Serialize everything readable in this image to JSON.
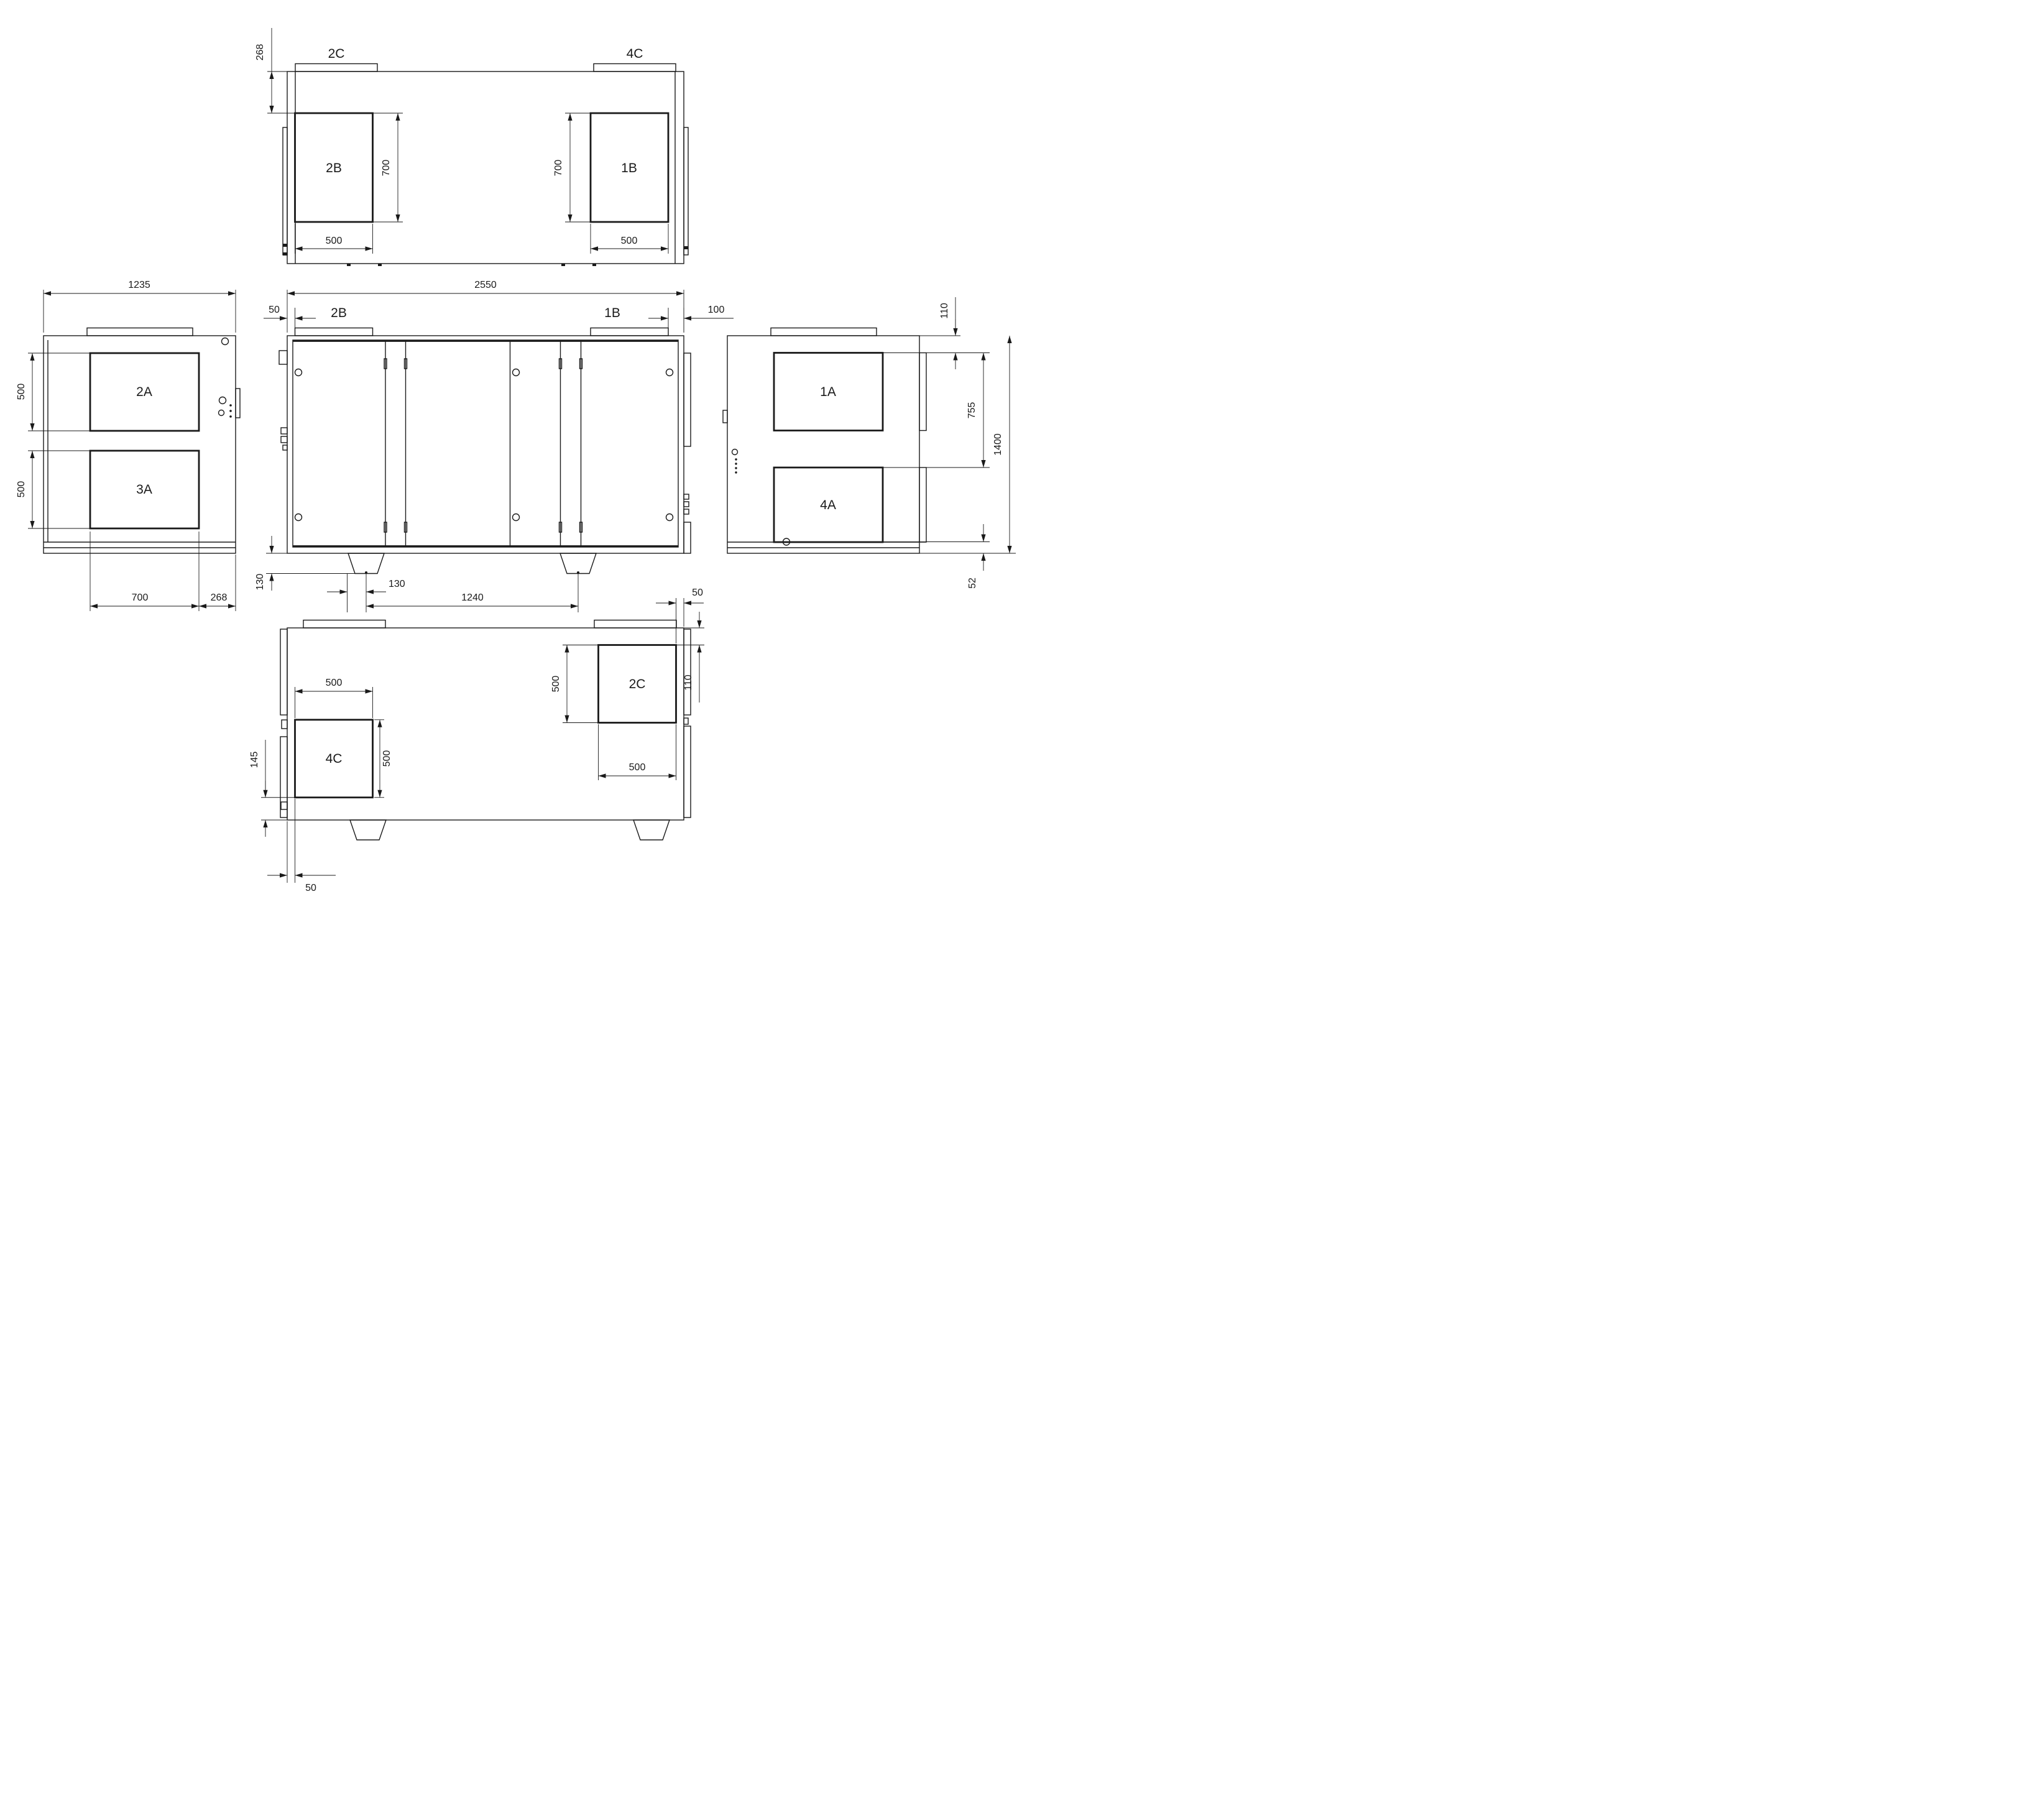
{
  "drawing": {
    "type": "AHU multi-view dimensioned technical drawing",
    "line_color": "#1a1a1a",
    "background": "#ffffff",
    "views": {
      "top": {
        "tab_left": "2C",
        "tab_right": "4C",
        "opening_left": "2B",
        "opening_right": "1B",
        "dim_offset": "268",
        "dim_depth_left": "700",
        "dim_depth_right": "700",
        "dim_width_left": "500",
        "dim_width_right": "500"
      },
      "front": {
        "dim_width": "2550",
        "dim_flange_left": "50",
        "flange_left": "2B",
        "flange_right": "1B",
        "dim_flange_right": "100",
        "dim_foot_height": "130",
        "dim_foot_offset": "130",
        "dim_foot_spacing": "1240"
      },
      "left": {
        "dim_width": "1235",
        "opening_top": "2A",
        "opening_bottom": "3A",
        "dim_opening_top": "500",
        "dim_opening_bottom": "500",
        "dim_bottom_width": "700",
        "dim_bottom_offset": "268"
      },
      "right": {
        "opening_top": "1A",
        "opening_bottom": "4A",
        "dim_top_offset": "110",
        "dim_span": "755",
        "dim_height": "1400",
        "dim_drain": "52"
      },
      "bottom": {
        "dim_top_offset": "50",
        "opening_right": "2C",
        "dim_right_height": "500",
        "dim_right_width": "500",
        "dim_right_offset": "110",
        "opening_left": "4C",
        "dim_left_width": "500",
        "dim_left_height": "500",
        "dim_left_bottom": "145",
        "dim_left_offset": "50"
      }
    }
  }
}
